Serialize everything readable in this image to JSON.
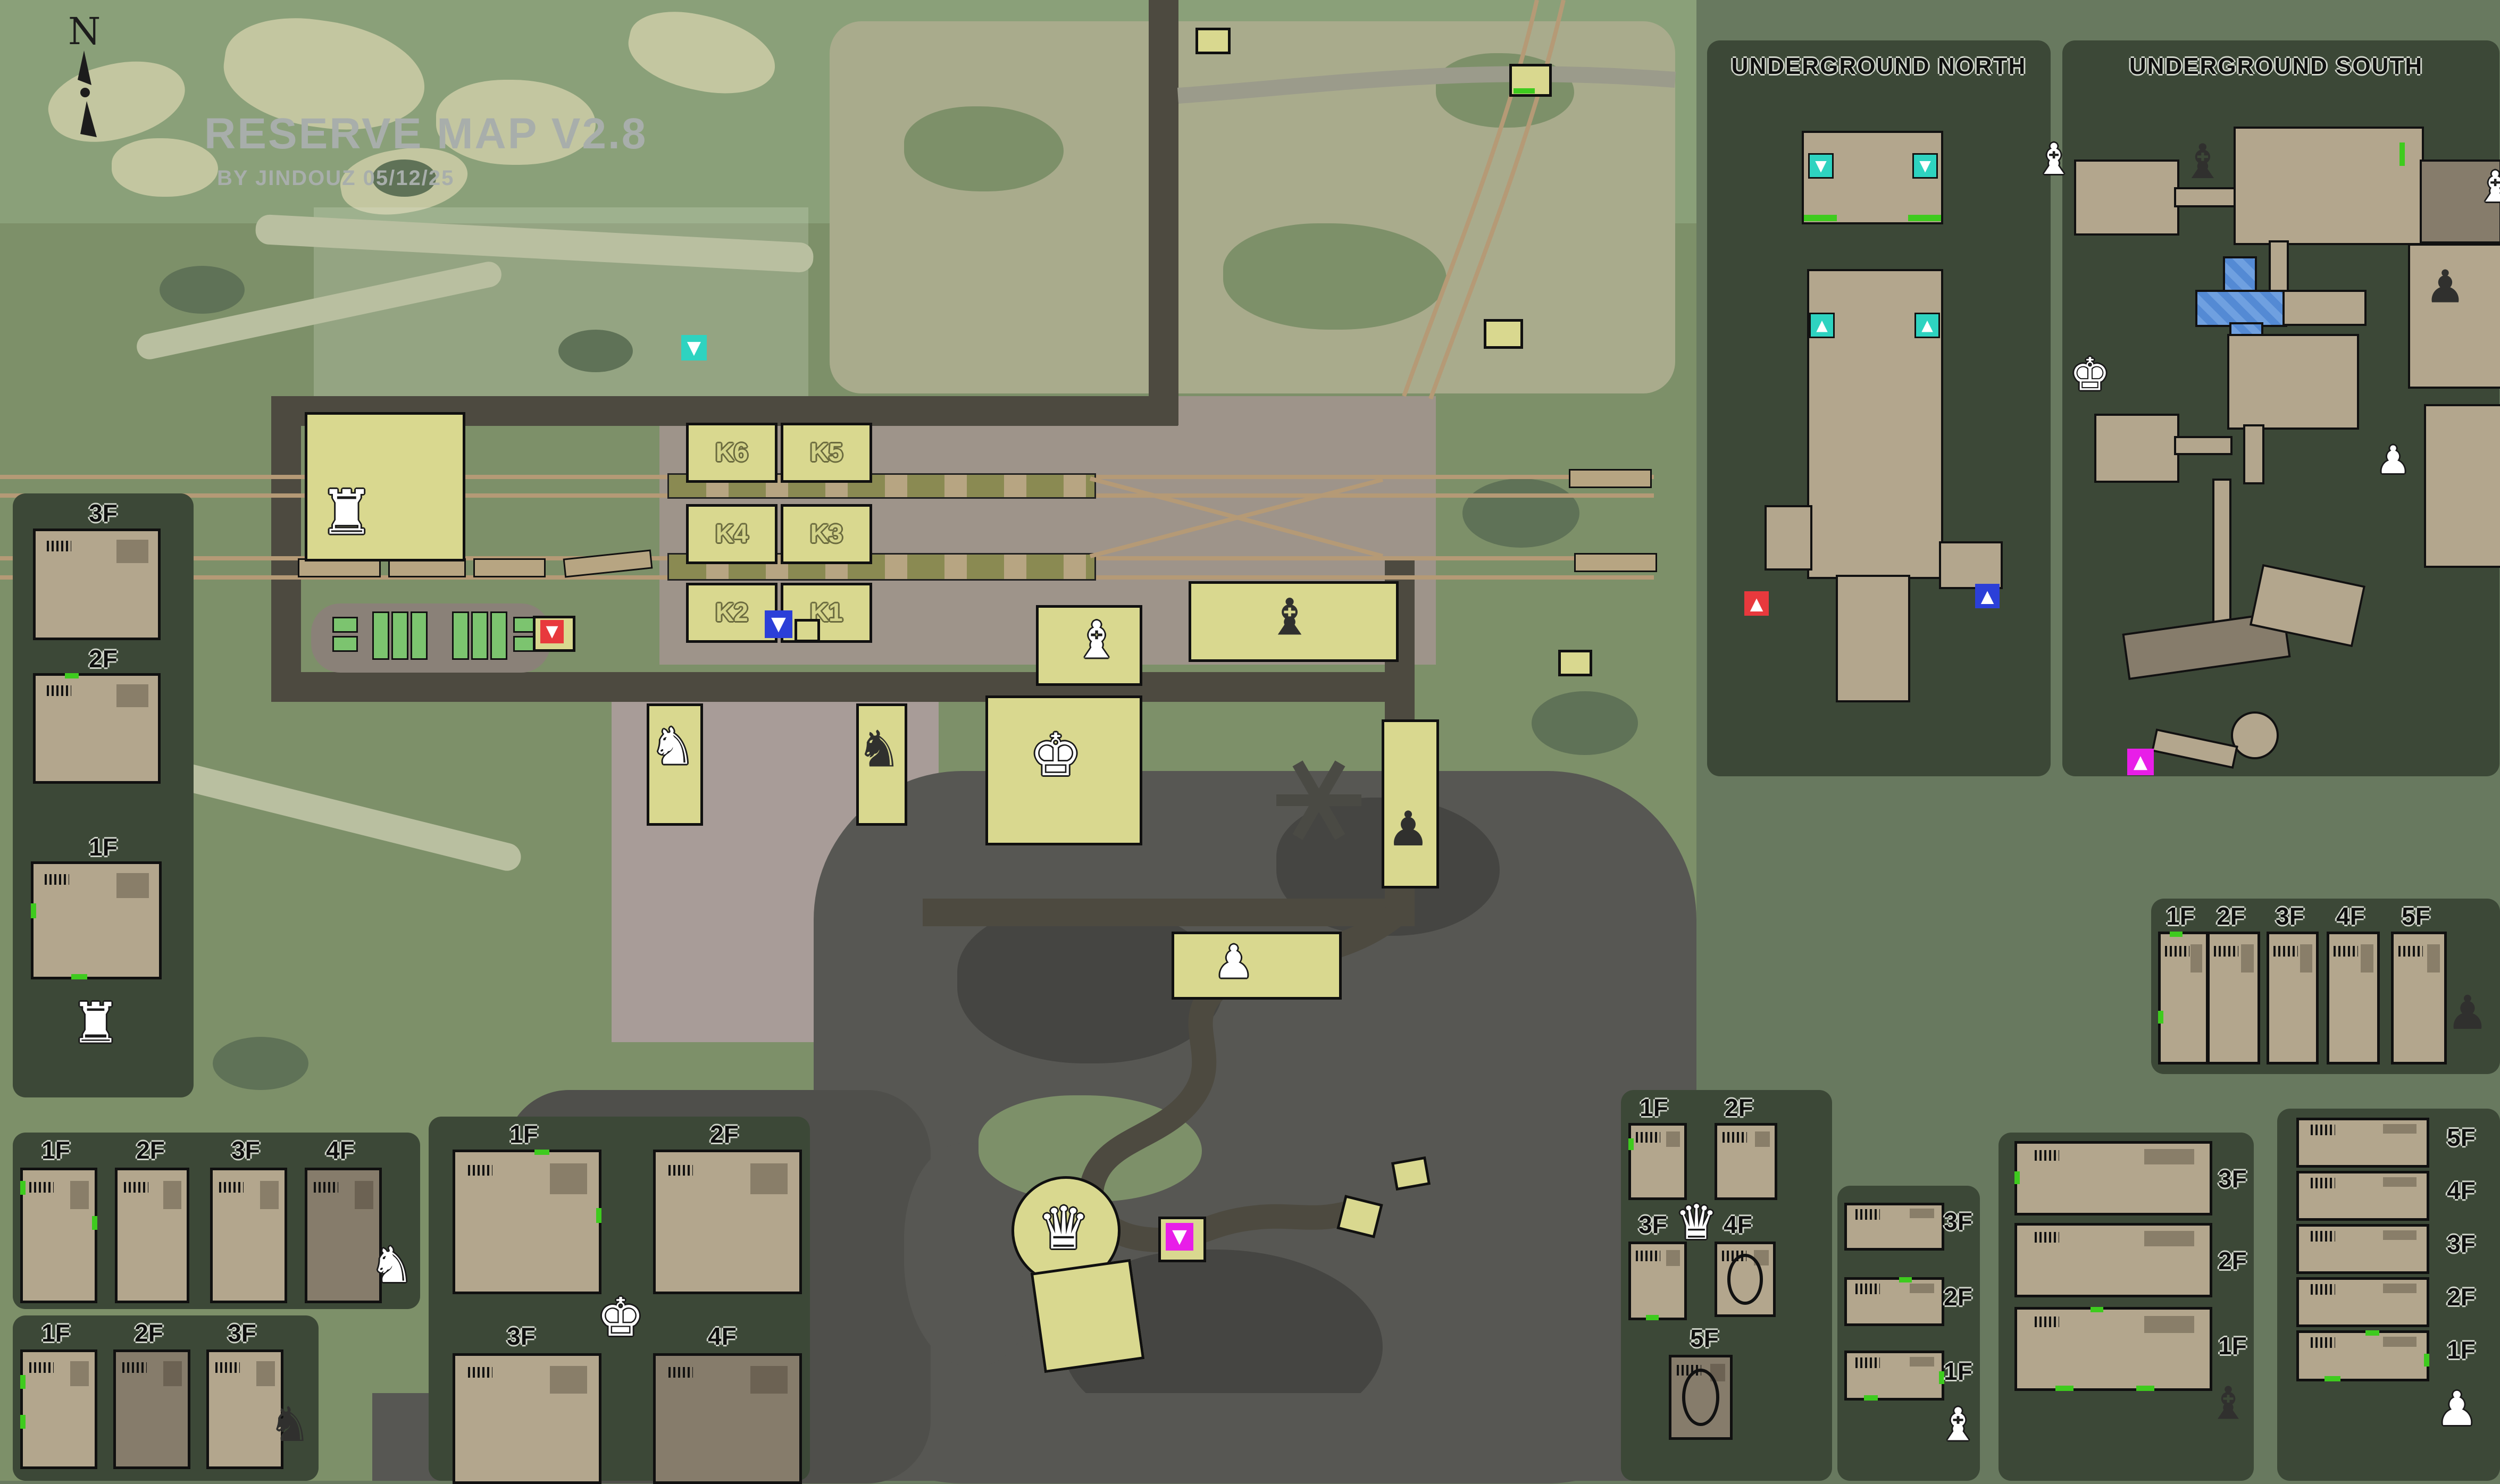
{
  "title": {
    "heading": "RESERVE MAP V2.8",
    "subheading": "BY JINDOUZ 05/12/25"
  },
  "compass": {
    "label": "N"
  },
  "glyphs": {
    "rook": "♜",
    "knight": "♞",
    "bishop": "♝",
    "queen": "♛",
    "king": "♚",
    "pawn": "♟",
    "triangle_up": "▲",
    "triangle_down": "▼"
  },
  "colors": {
    "background": "#68795f",
    "panel": "#3c4837",
    "terrain_green": "#7d9069",
    "camo_khaki": "#c3c6a0",
    "building_yellow": "#d9d88f",
    "floor_tan": "#b3a68d",
    "road_dark": "#4d4a40",
    "rock_dark": "#575753",
    "rail_tan": "#b59a76",
    "marker_teal": "#2ed3c0",
    "marker_blue": "#2b3fd8",
    "marker_red": "#e8393d",
    "marker_magenta": "#e81ee8",
    "marker_green": "#3ecb1e"
  },
  "main_map": {
    "bunkers": [
      "K6",
      "K5",
      "K4",
      "K3",
      "K2",
      "K1"
    ]
  },
  "panels": {
    "station": {
      "floors": [
        "3F",
        "2F",
        "1F"
      ]
    },
    "white_knight": {
      "floors": [
        "1F",
        "2F",
        "3F",
        "4F"
      ]
    },
    "black_knight": {
      "floors": [
        "1F",
        "2F",
        "3F"
      ]
    },
    "white_king": {
      "floors": [
        "1F",
        "2F",
        "3F",
        "4F"
      ]
    },
    "white_queen": {
      "floors": [
        "1F",
        "2F",
        "3F",
        "4F",
        "5F"
      ]
    },
    "white_bishop": {
      "floors": [
        "3F",
        "2F",
        "1F"
      ]
    },
    "black_bishop": {
      "floors": [
        "3F",
        "2F",
        "1F"
      ]
    },
    "white_pawn": {
      "floors": [
        "5F",
        "4F",
        "3F",
        "2F",
        "1F"
      ]
    },
    "black_pawn": {
      "floors": [
        "1F",
        "2F",
        "3F",
        "4F",
        "5F"
      ]
    },
    "underground_north": {
      "title": "UNDERGROUND NORTH"
    },
    "underground_south": {
      "title": "UNDERGROUND SOUTH"
    }
  }
}
